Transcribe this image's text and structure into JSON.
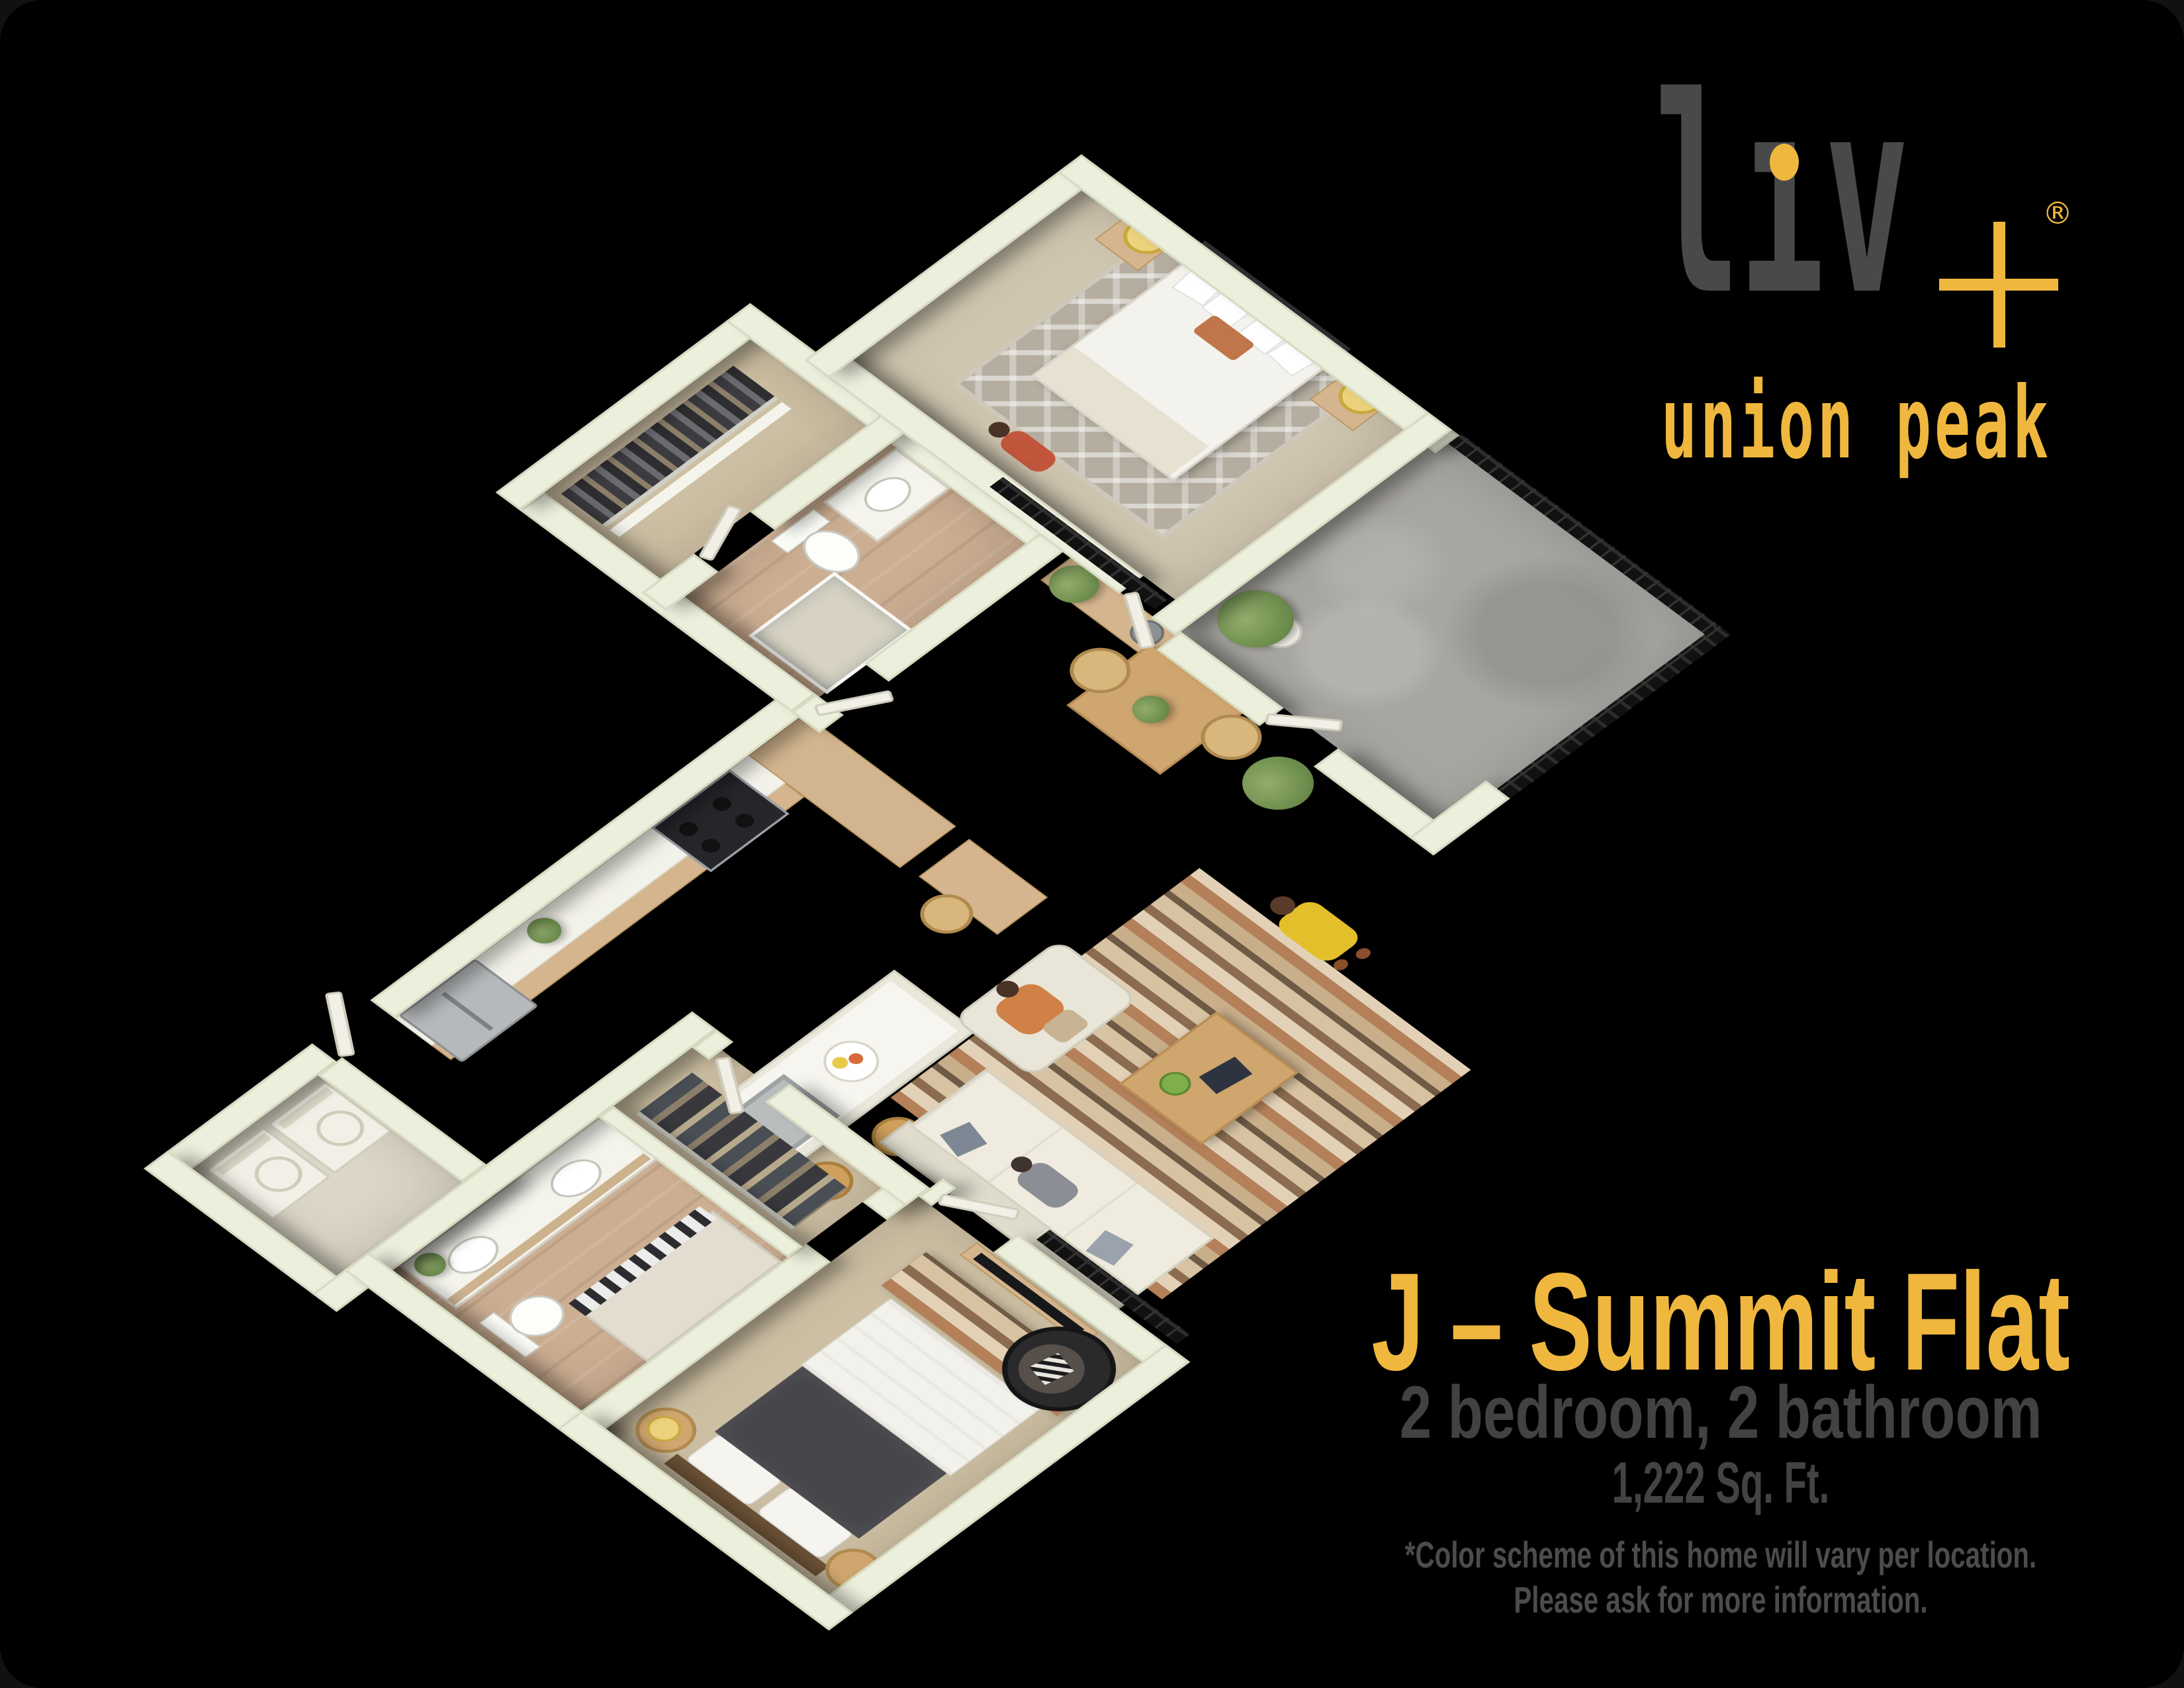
{
  "brand": {
    "name": "liv+",
    "wordmark_display": "lıv",
    "registered": "®",
    "subtitle": "union peak",
    "gold": "#efb73e",
    "gray": "#49494b"
  },
  "plan_label": {
    "title": "J – Summit Flat",
    "subtitle": "2 bedroom, 2 bathroom",
    "area": "1,222 Sq. Ft.",
    "disclaimer_line1": "*Color scheme of this home will vary per location.",
    "disclaimer_line2": "Please ask for more information."
  },
  "palette": {
    "background": "#000000",
    "accent_gold": "#efb73e",
    "text_gray": "#434346",
    "wall_cream": "#edefdd",
    "wood_floor": "#c8a789",
    "bedroom_carpet": "#cdbfa3",
    "patio_concrete": "#a8a6a1",
    "cabinet_wood": "#d4b58e",
    "black_metal": "#141414"
  },
  "floor_plan": {
    "type": "3d isometric apartment rendering",
    "rooms": [
      "kitchen",
      "laundry",
      "walk-in closet",
      "bathroom 1",
      "primary bedroom",
      "dining nook",
      "patio",
      "living room",
      "bathroom 2",
      "closet 2",
      "bedroom 2"
    ],
    "furnishings": [
      "refrigerator",
      "range",
      "kitchen island with sink and bar stools",
      "washer and dryer",
      "queen bed with rug and nightstands",
      "dining table with chairs",
      "sofa, armchair, coffee table and striped rug",
      "double vanity",
      "toilet",
      "shower",
      "tv console",
      "papasan chair",
      "potted plants",
      "four people figures"
    ]
  }
}
